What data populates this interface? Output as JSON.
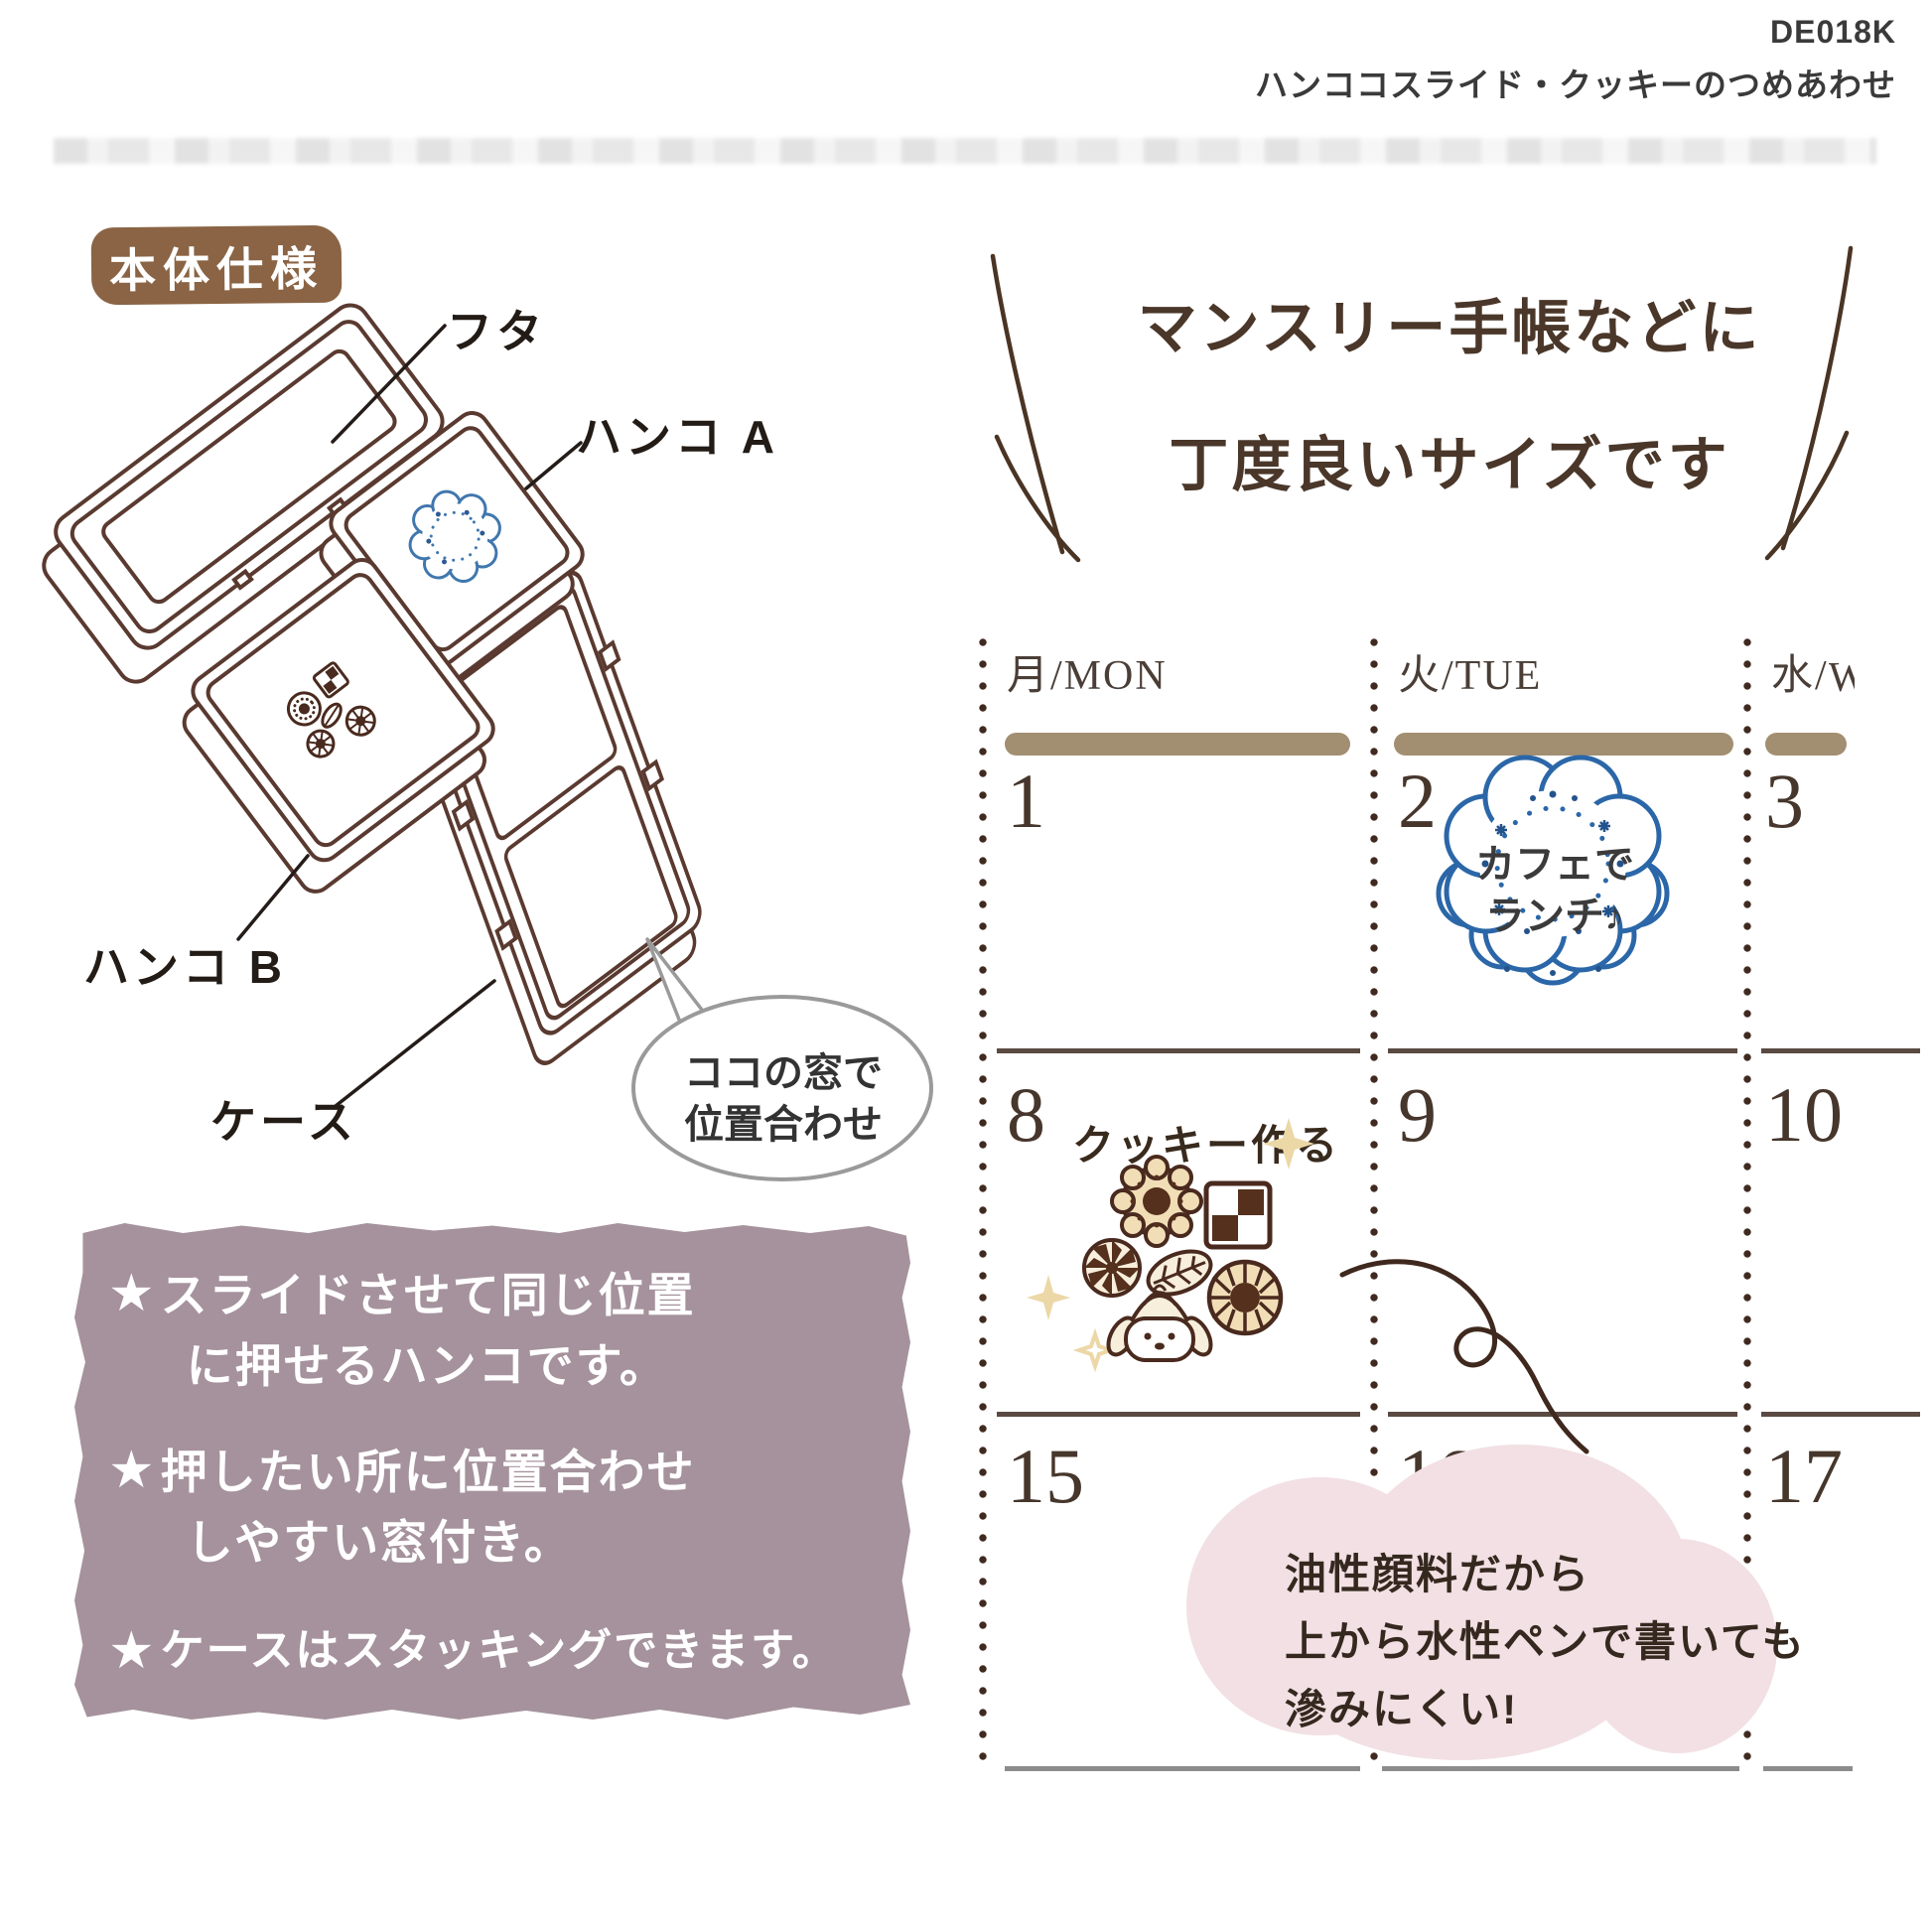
{
  "header": {
    "code": "DE018K",
    "name": "ハンココスライド・クッキーのつめあわせ"
  },
  "spec_section": {
    "badge": "本体仕様",
    "labels": {
      "lid": "フタ",
      "stamp_a": "ハンコ A",
      "stamp_b": "ハンコ B",
      "case": "ケース"
    },
    "bubble": {
      "line1": "ココの窓で",
      "line2": "位置合わせ"
    }
  },
  "features_box": {
    "bullet": "★",
    "items": [
      {
        "line1": "スライドさせて同じ位置",
        "line2": "に押せるハンコです。"
      },
      {
        "line1": "押したい所に位置合わせ",
        "line2": "しやすい窓付き。"
      },
      {
        "line1": "ケースはスタッキングできます。",
        "line2": ""
      }
    ]
  },
  "size_heading": {
    "line1": "マンスリー手帳などに",
    "line2": "丁度良いサイズです"
  },
  "calendar": {
    "columns": [
      {
        "header": "月/MON",
        "dates": [
          "1",
          "8",
          "15"
        ]
      },
      {
        "header": "火/TUE",
        "dates": [
          "2",
          "9",
          "16"
        ]
      },
      {
        "header_prefix": "水/",
        "header_cut": "W",
        "dates": [
          "3",
          "10",
          "17"
        ]
      }
    ],
    "cafe_stamp": {
      "line1": "カフェで",
      "line2": "ランチ♪"
    },
    "cookie_note": "クッキー作る",
    "ink_note": {
      "line1": "油性顔料だから",
      "line2": "上から水性ペンで書いても",
      "line3": "滲みにくい!"
    }
  },
  "colors": {
    "badge_brown": "#8a6444",
    "notes_purple": "#a5929c",
    "stamp_blue": "#2b67a8",
    "cookie_brown": "#55301c",
    "blob_pink": "#f2e0e4",
    "calendar_bar_tan": "#a28e71",
    "dot_line_brown": "#402a20",
    "diagram_line": "#5a3a30"
  }
}
